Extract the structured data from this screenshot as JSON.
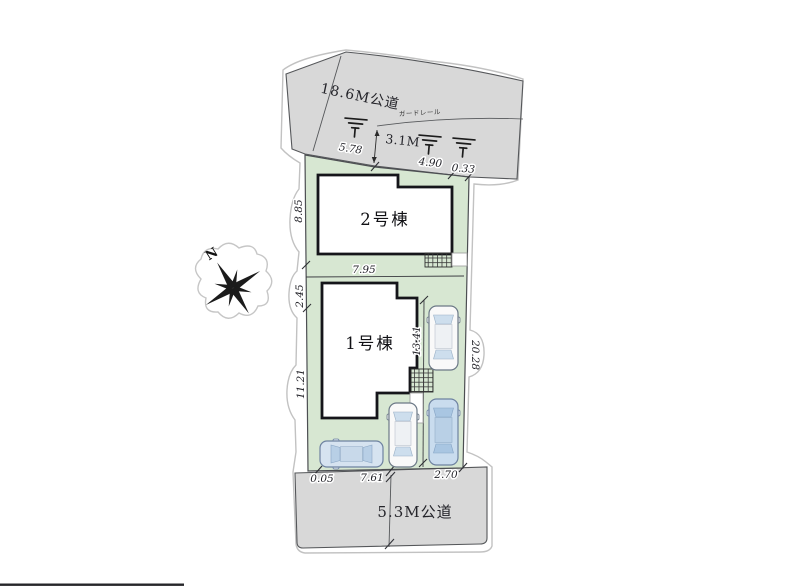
{
  "site_plan": {
    "compass": {
      "north_label": "N"
    },
    "top_road": {
      "name": "18.6M公道",
      "width": "3.1M",
      "guardrail": "ガードレール",
      "edge_dims": [
        "5.78",
        "4.90",
        "0.33"
      ]
    },
    "bottom_road": {
      "name": "5.3M公道",
      "edge_dims": [
        "0.05",
        "7.61",
        "2.70"
      ]
    },
    "left_edge_dims": [
      "8.85",
      "2.45",
      "11.21"
    ],
    "right_edge_dim": "20.28",
    "inner_dims": {
      "lot_width": "7.95",
      "parking_length": "13.41"
    },
    "buildings": [
      {
        "label": "2号棟"
      },
      {
        "label": "1号棟"
      }
    ],
    "colors": {
      "lot_green": "#d7e7d2",
      "road_gray": "#d8d8d8",
      "building_outline": "#15151a",
      "car_blue": "#c9dcee",
      "car_white": "#f9f9f9",
      "outline_gray": "#c2c2c2"
    }
  }
}
